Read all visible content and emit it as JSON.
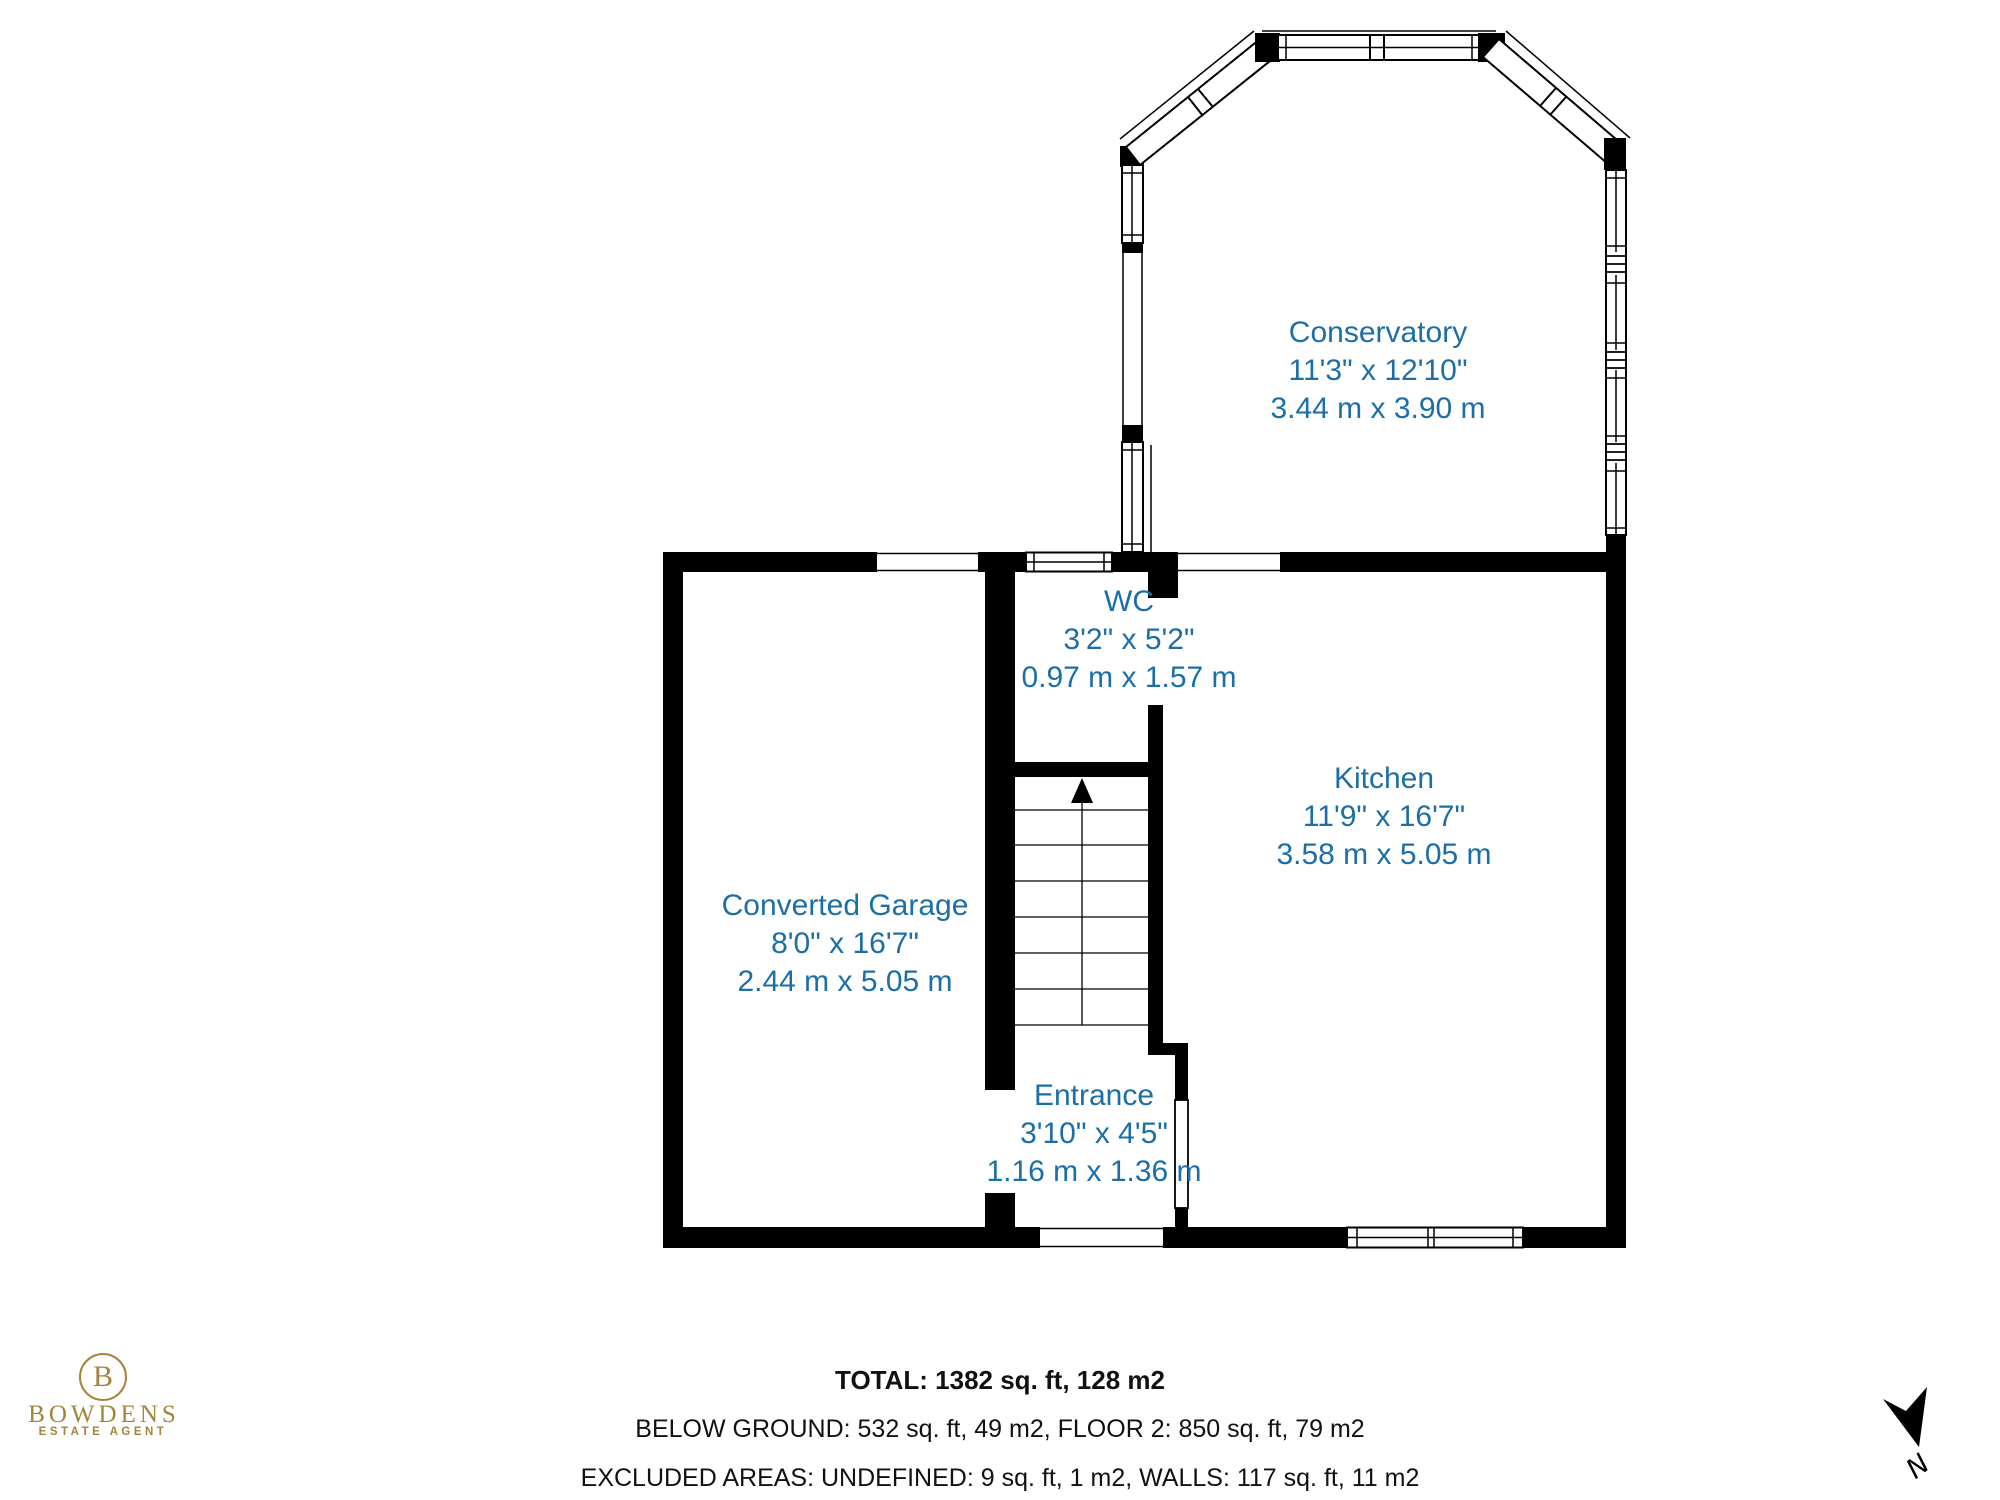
{
  "rooms": {
    "conservatory": {
      "name": "Conservatory",
      "imperial": "11'3\" x 12'10\"",
      "metric": "3.44 m x 3.90 m"
    },
    "wc": {
      "name": "WC",
      "imperial": "3'2\" x 5'2\"",
      "metric": "0.97 m x 1.57 m"
    },
    "kitchen": {
      "name": "Kitchen",
      "imperial": "11'9\" x 16'7\"",
      "metric": "3.58 m x 5.05 m"
    },
    "garage": {
      "name": "Converted Garage",
      "imperial": "8'0\" x 16'7\"",
      "metric": "2.44 m x 5.05 m"
    },
    "entrance": {
      "name": "Entrance",
      "imperial": "3'10\" x 4'5\"",
      "metric": "1.16 m x 1.36 m"
    }
  },
  "footer": {
    "total": "TOTAL: 1382 sq. ft, 128 m2",
    "breakdown": "BELOW GROUND: 532 sq. ft, 49 m2, FLOOR 2: 850 sq. ft, 79 m2",
    "excluded": "EXCLUDED AREAS: UNDEFINED: 9 sq. ft, 1 m2, WALLS: 117 sq. ft, 11 m2"
  },
  "logo": {
    "initial": "B",
    "name": "BOWDENS",
    "tagline": "ESTATE AGENT"
  },
  "compass": {
    "label": "N"
  },
  "colors": {
    "wall": "#000000",
    "room_text": "#1c6fa6",
    "brand_gold": "#a3853a"
  }
}
